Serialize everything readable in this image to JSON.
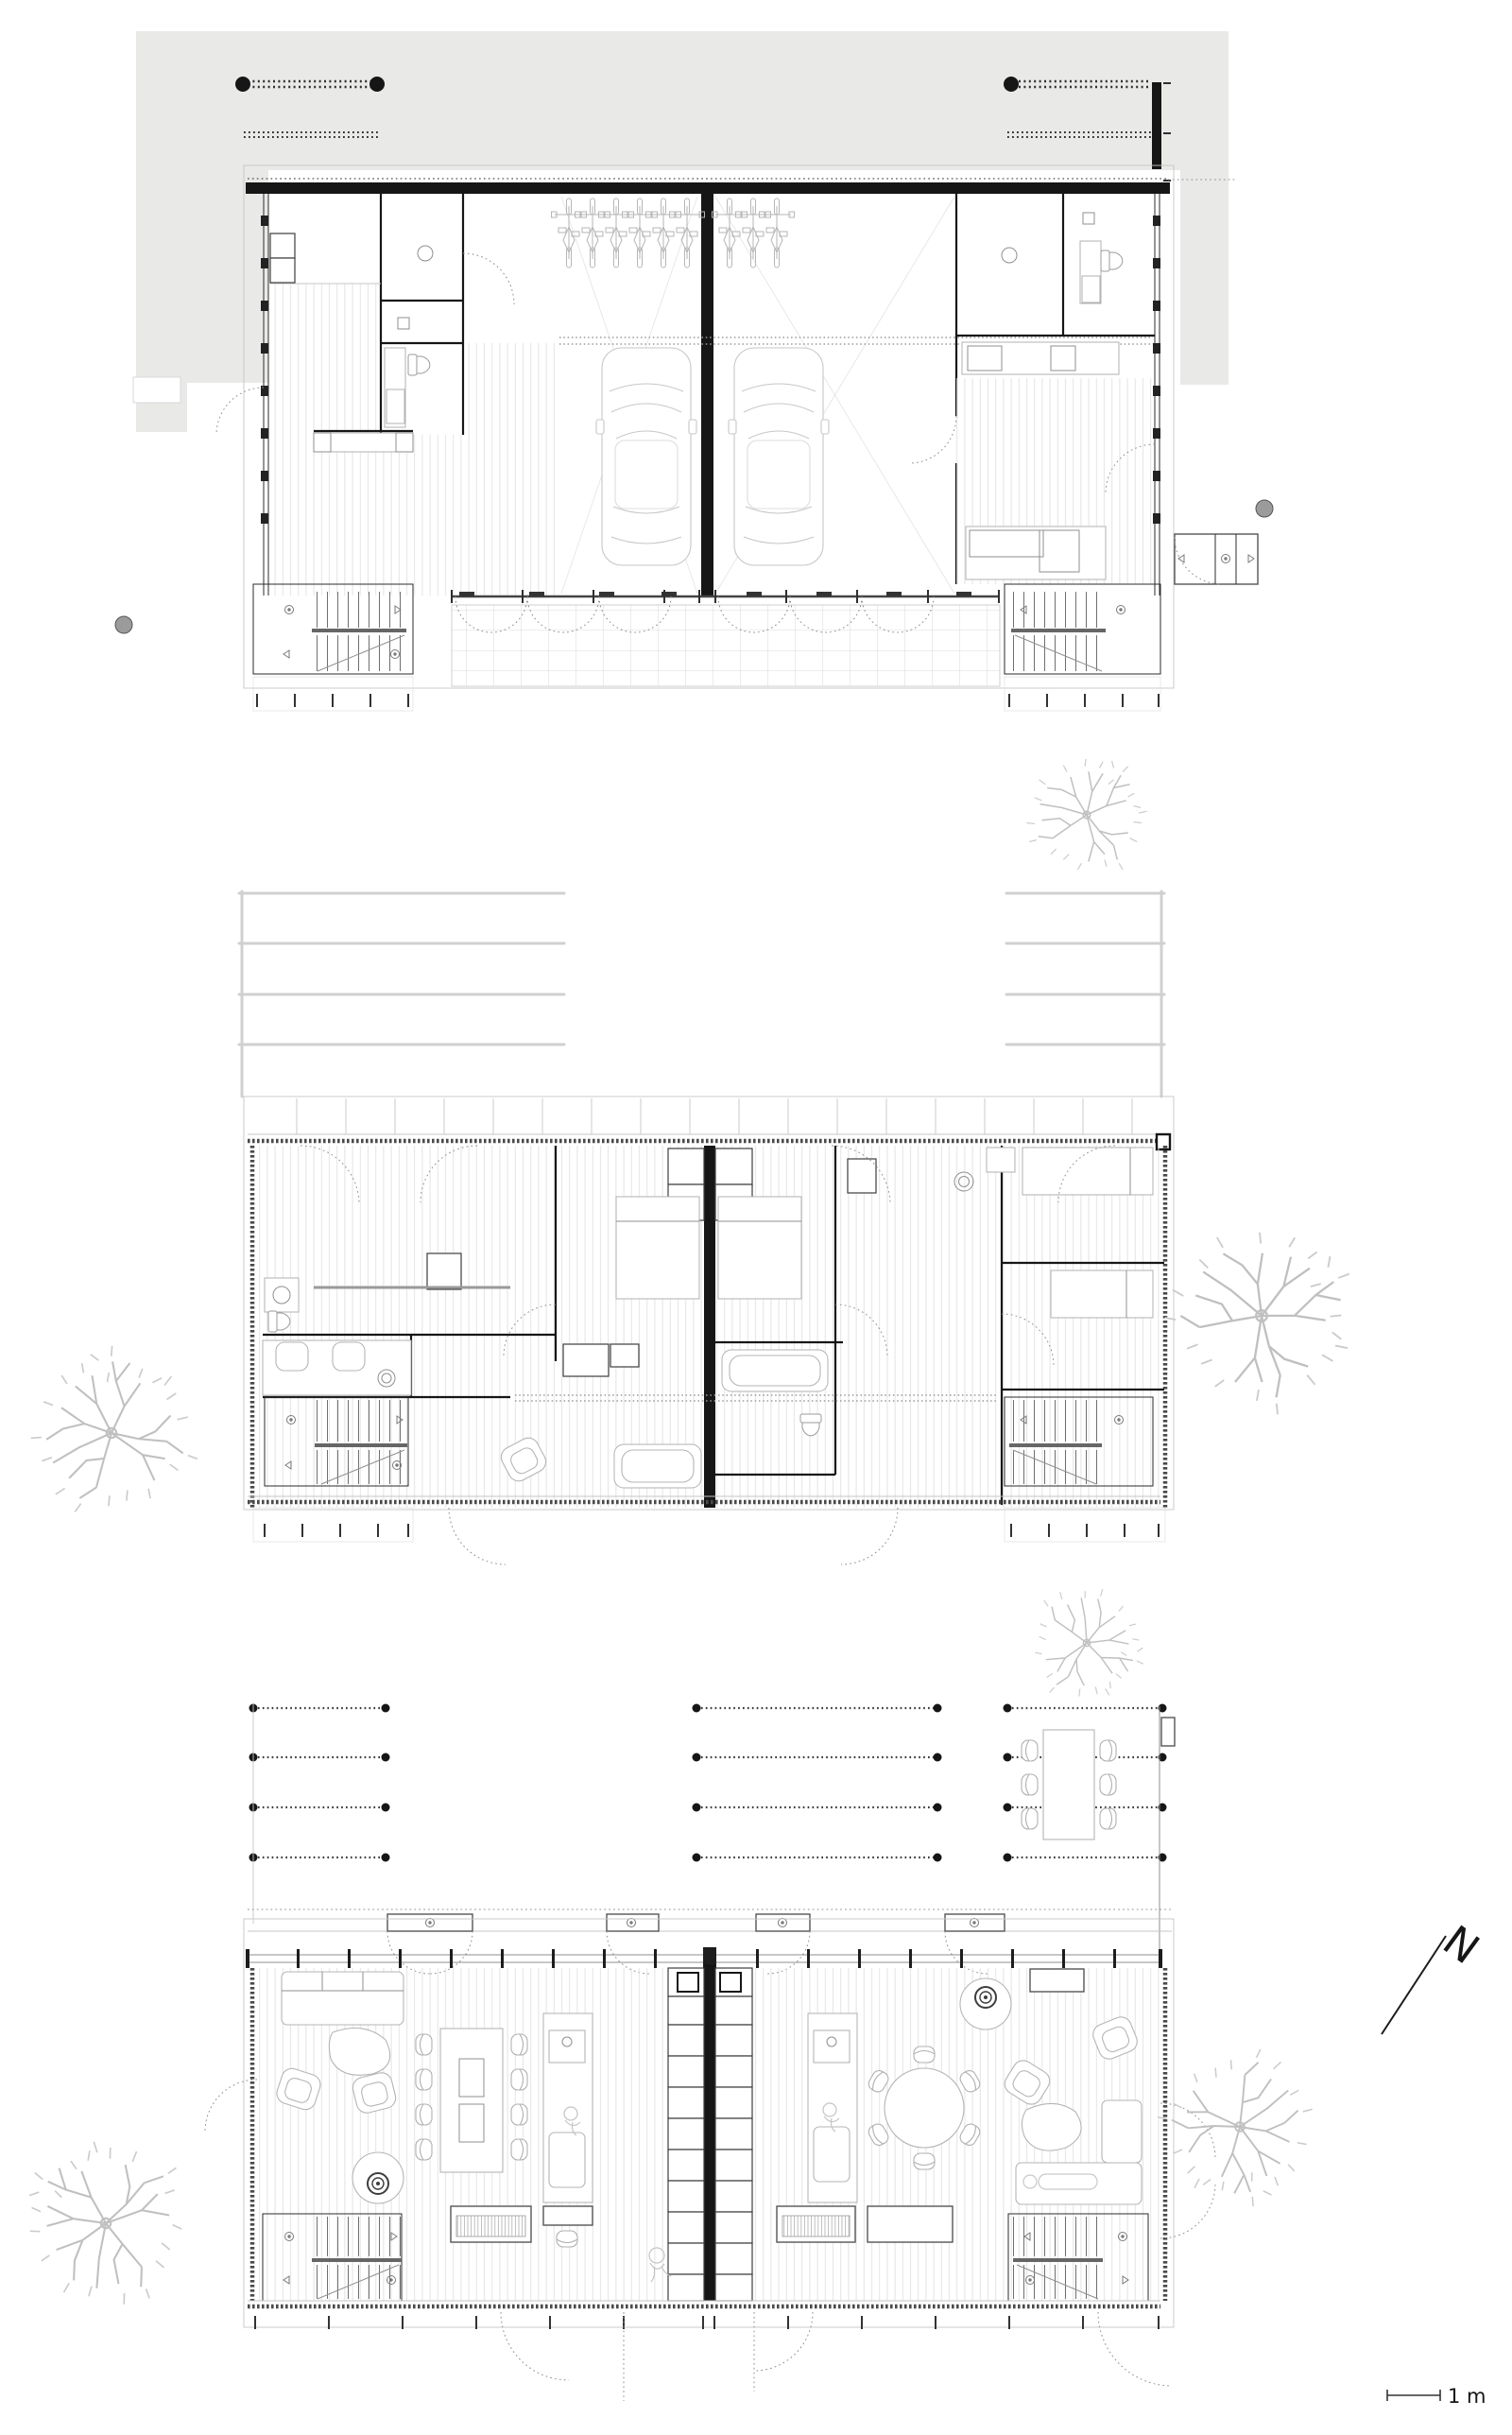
{
  "colors": {
    "paper": "#ffffff",
    "paving_gray": "#e9e9e8",
    "wall_black": "#161616",
    "line_dark": "#2b2b2b",
    "line_mid": "#8f8f8f",
    "line_light": "#c6c6c6",
    "tree_gray": "#c0c0c0",
    "bollard_gray": "#9b9b9b"
  },
  "scale_bar": {
    "label": "1 m"
  },
  "north_arrow": {
    "letter": "N"
  },
  "levels": [
    {
      "name": "garage-level-plan"
    },
    {
      "name": "bedroom-level-plan"
    },
    {
      "name": "living-level-plan"
    }
  ]
}
